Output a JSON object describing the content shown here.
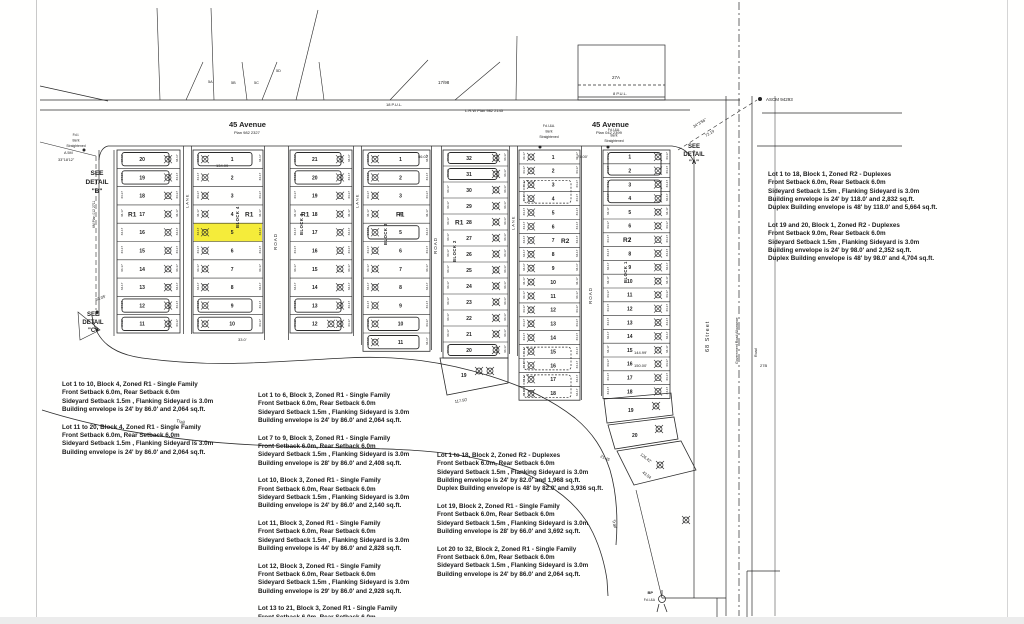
{
  "colors": {
    "ink": "#2b2b2b",
    "dim_text": "#5a5a5a",
    "highlight": "#f3e918",
    "paper": "#ffffff"
  },
  "avenue_left": {
    "name": "45 Avenue",
    "plan": "Plan 982 2327"
  },
  "avenue_right": {
    "name": "45 Avenue",
    "plan": "Plan 042 2399"
  },
  "top_labels": {
    "fraction": "17/98",
    "lrw_plan": "L.R.W Plan 982 2145",
    "lot_27a": "27A",
    "pul_8": "8 P.U.L.",
    "pul_18": "18 P.U.L.",
    "ascm": "ASCM 94293",
    "bearing": "34°3'56\"",
    "bearing_dist": "72.19",
    "fan_lots": [
      "5A",
      "5B",
      "5C",
      "5D"
    ]
  },
  "see_details": {
    "a": [
      "SEE",
      "DETAIL",
      "\"A\""
    ],
    "b": [
      "SEE",
      "DETAIL",
      "\"B\""
    ],
    "c": [
      "SEE",
      "DETAIL",
      "\"C\""
    ]
  },
  "fd_notes": [
    {
      "x": 76,
      "y": 136,
      "lines": [
        "Fd.I.",
        "Bent",
        "Straightened"
      ]
    },
    {
      "x": 549,
      "y": 127,
      "lines": [
        "Fd.I.&A.",
        "Bent",
        "Straightened"
      ]
    },
    {
      "x": 614,
      "y": 131,
      "lines": [
        "Fd.I.&A.",
        "Bent",
        "Straightened"
      ]
    }
  ],
  "left_edge": {
    "plan_text": "6M Plan 012 2711",
    "a5m": "A 5M",
    "bearing": "33°18'12\""
  },
  "streets": {
    "lane": "LANE",
    "road": "ROAD",
    "street68": "68 Street",
    "gov_allowance": "Government Road Allowance",
    "road_small": "Road",
    "label_27b": "27B",
    "trail": "Trail"
  },
  "corner_marker": {
    "top": "BP",
    "bottom": "Fd.I.&A"
  },
  "edge_dim": "34.17",
  "strips": [
    {
      "id": "block4-west",
      "x": 117,
      "w": 63,
      "top": 150,
      "rowH": 18.3,
      "numSide": "left",
      "lots": [
        "20",
        "19",
        "18",
        "17",
        "16",
        "15",
        "14",
        "13",
        "12",
        "11"
      ],
      "zone": {
        "label": "R1",
        "row": 3,
        "dx": 11
      },
      "env": [
        0,
        1,
        8,
        9
      ]
    },
    {
      "id": "block4-east",
      "x": 193,
      "w": 70,
      "top": 150,
      "rowH": 18.3,
      "numSide": "right",
      "lots": [
        "1",
        "2",
        "3",
        "4",
        "5",
        "6",
        "7",
        "8",
        "9",
        "10"
      ],
      "zone": {
        "label": "R1",
        "row": 3,
        "dx": 52
      },
      "env": [
        0,
        8,
        9
      ],
      "highlight": 4,
      "block": {
        "label": "BLOCK 4",
        "dx": 46,
        "dy": 78
      }
    },
    {
      "id": "block3-west",
      "x": 290,
      "w": 62,
      "top": 150,
      "rowH": 18.3,
      "numSide": "left",
      "lots": [
        "21",
        "20",
        "19",
        "18",
        "17",
        "16",
        "15",
        "14",
        "13",
        "12"
      ],
      "zone": {
        "label": "R1",
        "row": 3,
        "dx": 11
      },
      "env": [
        0,
        1,
        8,
        9
      ],
      "dbl": [
        9
      ],
      "block": {
        "label": "BLOCK 3",
        "dx": 13,
        "dy": 85
      }
    },
    {
      "id": "block3-east",
      "x": 363,
      "w": 67,
      "top": 150,
      "rowH": 18.3,
      "numSide": "right",
      "lots": [
        "1",
        "2",
        "3",
        "4",
        "5",
        "6",
        "7",
        "8",
        "9",
        "10",
        "11"
      ],
      "zone": {
        "label": "R1",
        "row": 3,
        "dx": 33
      },
      "env": [
        0,
        1,
        4,
        9,
        10
      ],
      "block": {
        "label": "BLOCK 3",
        "dx": 24,
        "dy": 95
      }
    },
    {
      "id": "block2-west",
      "x": 443,
      "w": 65,
      "top": 150,
      "rowH": 16.0,
      "numSide": "left",
      "lots": [
        "32",
        "31",
        "30",
        "29",
        "28",
        "27",
        "26",
        "25",
        "24",
        "23",
        "22",
        "21",
        "20"
      ],
      "zone": {
        "label": "R1",
        "row": 4,
        "dx": 12
      },
      "env": [
        0,
        1,
        12
      ],
      "block": {
        "label": "BLOCK 2",
        "dx": 13,
        "dy": 112
      }
    },
    {
      "id": "block2-east",
      "x": 519,
      "w": 61,
      "top": 150,
      "rowH": 13.9,
      "numSide": "right",
      "lots": [
        "1",
        "2",
        "3",
        "4",
        "5",
        "6",
        "7",
        "8",
        "9",
        "10",
        "11",
        "12",
        "13",
        "14",
        "15",
        "16",
        "17",
        "18"
      ],
      "zone": {
        "label": "R2",
        "row": 6,
        "dx": 42
      },
      "spanEnvDashed": [
        [
          2,
          3
        ],
        [
          14,
          15
        ],
        [
          16,
          17
        ]
      ]
    },
    {
      "id": "block1",
      "x": 603,
      "w": 67,
      "top": 150,
      "rowH": 13.8,
      "numSide": "left",
      "lots": [
        "1",
        "2",
        "3",
        "4",
        "5",
        "6",
        "7",
        "8",
        "9",
        "10",
        "11",
        "12",
        "13",
        "14",
        "15",
        "16",
        "17",
        "18"
      ],
      "zone": {
        "label": "R2",
        "row": 6,
        "dx": 20
      },
      "spanEnv": [
        [
          0,
          1
        ],
        [
          2,
          3
        ]
      ],
      "block": {
        "label": "BLOCK 1",
        "dx": 24,
        "dy": 133
      }
    }
  ],
  "extra_lots": [
    {
      "id": "block2-lot19",
      "points": "440,358 508,358 508,383 447,395",
      "num": "19",
      "nx": 461,
      "ny": 377,
      "markers": [
        [
          479,
          371
        ],
        [
          490,
          371
        ]
      ]
    },
    {
      "id": "block1-lot19",
      "points": "604,399 671,393 673,415 607,423",
      "num": "19",
      "nx": 628,
      "ny": 412,
      "markers": [
        [
          656,
          406
        ]
      ]
    },
    {
      "id": "block1-lot20",
      "points": "608,425 674,417 678,439 615,449",
      "num": "20",
      "nx": 632,
      "ny": 437,
      "markers": [
        [
          659,
          429
        ]
      ]
    },
    {
      "id": "block1-sliver",
      "points": "617,451 681,441 696,470 634,485",
      "num": "",
      "nx": 0,
      "ny": 0,
      "markers": [
        [
          660,
          465
        ],
        [
          686,
          520
        ]
      ]
    }
  ],
  "dims": [
    {
      "t": "134.99",
      "x": 216,
      "y": 167
    },
    {
      "t": "56.07",
      "x": 418,
      "y": 158
    },
    {
      "t": "75.00'",
      "x": 577,
      "y": 158
    },
    {
      "t": "93.05'",
      "x": 96,
      "y": 301,
      "r": -20
    },
    {
      "t": "33.0'",
      "x": 238,
      "y": 341
    },
    {
      "t": "117.50'",
      "x": 455,
      "y": 403,
      "r": -10
    },
    {
      "t": "144.99'",
      "x": 634,
      "y": 354
    },
    {
      "t": "150.00'",
      "x": 634,
      "y": 367
    },
    {
      "t": "21.45",
      "x": 600,
      "y": 457,
      "r": 25
    },
    {
      "t": "126.42'",
      "x": 640,
      "y": 455,
      "r": 38
    },
    {
      "t": "43.54",
      "x": 642,
      "y": 473,
      "r": 38
    }
  ],
  "zoning_notes": [
    {
      "id": "block1-note",
      "x": 768,
      "y": 171,
      "paragraphs": [
        [
          "Lot 1 to 18, Block 1, Zoned R2 - Duplexes",
          "Front Setback 6.0m, Rear Setback 6.0m",
          "Sideyard Setback 1.5m , Flanking Sideyard is 3.0m",
          "Building envelope is 24' by 118.0'  and 2,832 sq.ft.",
          "Duplex Building envelope is 48' by 118.0'  and 5,664 sq.ft."
        ],
        [
          "Lot 19 and 20, Block 1, Zoned R2 - Duplexes",
          "Front Setback 9.0m, Rear Setback 6.0m",
          "Sideyard Setback 1.5m , Flanking Sideyard is 3.0m",
          "Building envelope is 24' by 98.0'  and 2,352 sq.ft.",
          "Duplex Building envelope is 48' by 98.0'  and 4,704 sq.ft."
        ]
      ]
    },
    {
      "id": "block4-note",
      "x": 62,
      "y": 381,
      "paragraphs": [
        [
          "Lot 1 to 10, Block 4, Zoned R1 - Single Family",
          "Front Setback 6.0m, Rear Setback 6.0m",
          "Sideyard Setback 1.5m , Flanking Sideyard is 3.0m",
          "Building envelope is 24' by 86.0'  and 2,064 sq.ft."
        ],
        [
          "Lot 11 to 20, Block 4, Zoned R1 - Single Family",
          "Front Setback 6.0m, Rear Setback 6.0m",
          "Sideyard Setback 1.5m , Flanking Sideyard is 3.0m",
          "Building envelope is 24' by 86.0'  and 2,064 sq.ft."
        ]
      ]
    },
    {
      "id": "block3-note",
      "x": 258,
      "y": 392,
      "paragraphs": [
        [
          "Lot 1 to 6, Block 3, Zoned R1 - Single Family",
          "Front Setback 6.0m, Rear Setback 6.0m",
          "Sideyard Setback 1.5m , Flanking Sideyard is 3.0m",
          "Building envelope is 24' by 86.0'  and 2,064 sq.ft."
        ],
        [
          "Lot 7 to 9, Block 3, Zoned R1 - Single Family",
          "Front Setback 6.0m, Rear Setback 6.0m",
          "Sideyard Setback 1.5m , Flanking Sideyard is 3.0m",
          "Building envelope is 28' by 86.0'  and 2,408 sq.ft."
        ],
        [
          "Lot 10, Block 3, Zoned R1 - Single Family",
          "Front Setback 6.0m, Rear Setback 6.0m",
          "Sideyard Setback 1.5m , Flanking Sideyard is 3.0m",
          "Building envelope is 24' by 86.0'  and 2,140 sq.ft."
        ],
        [
          "Lot 11, Block 3, Zoned R1 - Single Family",
          "Front Setback 6.0m, Rear Setback 6.0m",
          "Sideyard Setback 1.5m , Flanking Sideyard is 3.0m",
          "Building envelope is 44' by 86.0'  and 2,828 sq.ft."
        ],
        [
          "Lot 12, Block 3, Zoned R1 - Single Family",
          "Front Setback 6.0m, Rear Setback 6.0m",
          "Sideyard Setback 1.5m , Flanking Sideyard is 3.0m",
          "Building envelope is 29' by 86.0'  and 2,928 sq.ft."
        ],
        [
          "Lot 13 to 21, Block 3, Zoned R1 - Single Family",
          "Front Setback 6.0m, Rear Setback 6.0m",
          "Sideyard Setback 1.5m , Flanking Sideyard is 3.0m"
        ]
      ]
    },
    {
      "id": "block2-note",
      "x": 437,
      "y": 452,
      "paragraphs": [
        [
          "Lot 1 to 18, Block 2, Zoned R2 - Duplexes",
          "Front Setback 6.0m, Rear Setback 6.0m",
          "Sideyard Setback 1.5m , Flanking Sideyard is 3.0m",
          "Building envelope is 24' by 82.0'  and 1,968 sq.ft.",
          "Duplex Building envelope is 48' by 82.0'  and 3,936 sq.ft."
        ],
        [
          "Lot 19, Block 2, Zoned R1 - Single Family",
          "Front Setback 6.0m, Rear Setback 6.0m",
          "Sideyard Setback 1.5m , Flanking Sideyard is 3.0m",
          "Building envelope is 28' by 66.0'  and 3,692 sq.ft."
        ],
        [
          "Lot 20 to 32, Block 2, Zoned R1 - Single Family",
          "Front Setback 6.0m, Rear Setback 6.0m",
          "Sideyard Setback 1.5m , Flanking Sideyard is 3.0m",
          "Building envelope is 24' by 86.0'  and 2,064 sq.ft."
        ]
      ]
    }
  ]
}
